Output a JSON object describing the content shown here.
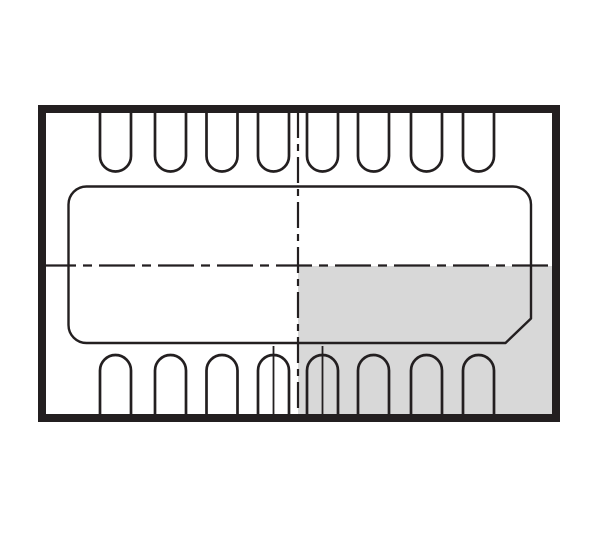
{
  "diagram": {
    "type": "ic-package-outline-drawing",
    "canvas": {
      "width": 600,
      "height": 533,
      "background": "#ffffff"
    },
    "colors": {
      "line": "#231f20",
      "shaded_region": "#d8d8d8",
      "background": "#ffffff"
    },
    "outer_border": {
      "x": 42,
      "y": 109,
      "width": 514,
      "height": 309,
      "stroke_width": 8
    },
    "shaded_quadrant": {
      "x": 298,
      "y": 266,
      "width": 254,
      "height": 148
    },
    "exposed_pad": {
      "left": 68.5,
      "top": 186.5,
      "right": 531,
      "bottom": 343,
      "corner_radius": 18,
      "chamfer": {
        "x1": 531,
        "y1": 318.5,
        "x2": 505.5,
        "y2": 343
      },
      "stroke_width": 2.4
    },
    "pins": {
      "count_top": 8,
      "count_bottom": 8,
      "left_edges": [
        100,
        155,
        206.5,
        258,
        307,
        358,
        411,
        463
      ],
      "width": 31,
      "stroke_width": 2.7,
      "top": {
        "edge_y": 110,
        "straight_to_y": 156
      },
      "bottom": {
        "edge_y": 417,
        "straight_to_y": 370.5
      }
    },
    "center_lines": {
      "stroke_width": 2.2,
      "vertical": {
        "x": 298,
        "y1": 112,
        "y2": 416,
        "dash": "26 6 7 6"
      },
      "horizontal": {
        "y": 265.5,
        "x1": 40,
        "x2": 556,
        "dash": "36 7 9 7"
      }
    },
    "extension_lines": {
      "stroke_width": 1.8,
      "items": [
        {
          "x": 273.5,
          "y1": 346,
          "y2": 415
        },
        {
          "x": 322.5,
          "y1": 346,
          "y2": 415
        }
      ]
    }
  }
}
